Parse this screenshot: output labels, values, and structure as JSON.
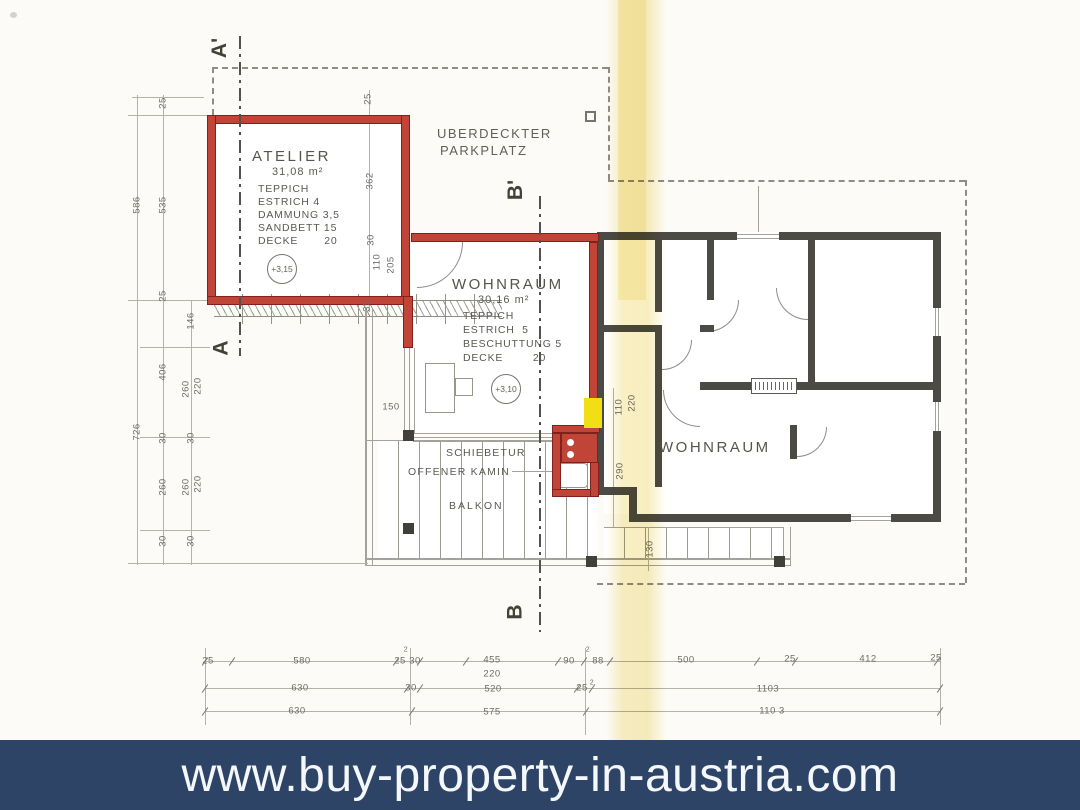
{
  "banner": {
    "url": "www.buy-property-in-austria.com"
  },
  "colors": {
    "banner_bg": "#2d4466",
    "banner_fg": "#f4f7fb",
    "wall_red": "#c04538",
    "wall_dark": "#4b4a45",
    "highlight_yellow": "#f1de15",
    "scan_stripe": "#f3e294",
    "paper": "#fcfbf8"
  },
  "section_markers": {
    "a_prime": "A'",
    "a": "A",
    "b_prime": "B'",
    "b": "B"
  },
  "site_labels": {
    "carport_line1": "UBERDECKTER",
    "carport_line2": "PARKPLATZ",
    "sliding_door": "SCHIEBETUR",
    "fireplace": "OFFENER  KAMIN",
    "balcony": "BALKON",
    "living_right": "WOHNRAUM"
  },
  "rooms": {
    "atelier": {
      "name": "ATELIER",
      "area": "31,08 m²",
      "specs": [
        "TEPPICH",
        "ESTRICH 4",
        "DAMMUNG 3,5",
        "SANDBETT 15",
        "DECKE       20"
      ],
      "elevation": "+3,15"
    },
    "wohnraum": {
      "name": "WOHNRAUM",
      "area": "30,16 m²",
      "specs": [
        "TEPPICH",
        "ESTRICH  5",
        "BESCHUTTUNG 5",
        "DECKE        20"
      ],
      "elevation": "+3,10"
    }
  },
  "dim_labels": [
    {
      "t": "586",
      "x": 137,
      "y": 205,
      "r": 1
    },
    {
      "t": "726",
      "x": 137,
      "y": 432,
      "r": 1
    },
    {
      "t": "25",
      "x": 163,
      "y": 103,
      "r": 1
    },
    {
      "t": "535",
      "x": 163,
      "y": 205,
      "r": 1
    },
    {
      "t": "25",
      "x": 163,
      "y": 296,
      "r": 1
    },
    {
      "t": "406",
      "x": 163,
      "y": 372,
      "r": 1
    },
    {
      "t": "30",
      "x": 163,
      "y": 438,
      "r": 1
    },
    {
      "t": "260",
      "x": 163,
      "y": 487,
      "r": 1
    },
    {
      "t": "30",
      "x": 163,
      "y": 541,
      "r": 1
    },
    {
      "t": "146",
      "x": 191,
      "y": 321,
      "r": 1
    },
    {
      "t": "260",
      "x": 186,
      "y": 389,
      "r": 1
    },
    {
      "t": "220",
      "x": 198,
      "y": 386,
      "r": 1
    },
    {
      "t": "30",
      "x": 191,
      "y": 438,
      "r": 1
    },
    {
      "t": "260",
      "x": 186,
      "y": 487,
      "r": 1
    },
    {
      "t": "220",
      "x": 198,
      "y": 484,
      "r": 1
    },
    {
      "t": "30",
      "x": 191,
      "y": 541,
      "r": 1
    },
    {
      "t": "25",
      "x": 368,
      "y": 99,
      "r": 1
    },
    {
      "t": "362",
      "x": 370,
      "y": 181,
      "r": 1
    },
    {
      "t": "30",
      "x": 371,
      "y": 240,
      "r": 1
    },
    {
      "t": "110",
      "x": 377,
      "y": 262,
      "r": 1
    },
    {
      "t": "205",
      "x": 391,
      "y": 265,
      "r": 1
    },
    {
      "t": "35",
      "x": 367,
      "y": 306,
      "r": 1
    },
    {
      "t": "110",
      "x": 619,
      "y": 407,
      "r": 1
    },
    {
      "t": "220",
      "x": 632,
      "y": 403,
      "r": 1
    },
    {
      "t": "290",
      "x": 620,
      "y": 471,
      "r": 1
    },
    {
      "t": "130",
      "x": 650,
      "y": 549,
      "r": 1
    },
    {
      "t": "150",
      "x": 391,
      "y": 407,
      "r": 0
    },
    {
      "t": "25",
      "x": 208,
      "y": 661,
      "r": 0
    },
    {
      "t": "580",
      "x": 302,
      "y": 661,
      "r": 0
    },
    {
      "t": "2",
      "x": 406,
      "y": 650,
      "r": 0,
      "sm": 1
    },
    {
      "t": "25",
      "x": 400,
      "y": 661,
      "r": 0
    },
    {
      "t": "30",
      "x": 415,
      "y": 661,
      "r": 0
    },
    {
      "t": "455",
      "x": 492,
      "y": 660,
      "r": 0
    },
    {
      "t": "220",
      "x": 492,
      "y": 674,
      "r": 0
    },
    {
      "t": "90",
      "x": 569,
      "y": 661,
      "r": 0
    },
    {
      "t": "2",
      "x": 588,
      "y": 650,
      "r": 0,
      "sm": 1
    },
    {
      "t": "88",
      "x": 598,
      "y": 661,
      "r": 0
    },
    {
      "t": "500",
      "x": 686,
      "y": 660,
      "r": 0
    },
    {
      "t": "25",
      "x": 790,
      "y": 659,
      "r": 0
    },
    {
      "t": "412",
      "x": 868,
      "y": 659,
      "r": 0
    },
    {
      "t": "25",
      "x": 936,
      "y": 658,
      "r": 0
    },
    {
      "t": "630",
      "x": 300,
      "y": 688,
      "r": 0
    },
    {
      "t": "30",
      "x": 411,
      "y": 688,
      "r": 0
    },
    {
      "t": "520",
      "x": 493,
      "y": 689,
      "r": 0
    },
    {
      "t": "25",
      "x": 582,
      "y": 688,
      "r": 0
    },
    {
      "t": "2",
      "x": 592,
      "y": 683,
      "r": 0,
      "sm": 1
    },
    {
      "t": "1103",
      "x": 768,
      "y": 689,
      "r": 0
    },
    {
      "t": "630",
      "x": 297,
      "y": 711,
      "r": 0
    },
    {
      "t": "575",
      "x": 492,
      "y": 712,
      "r": 0
    },
    {
      "t": "110 3",
      "x": 772,
      "y": 711,
      "r": 0
    }
  ]
}
